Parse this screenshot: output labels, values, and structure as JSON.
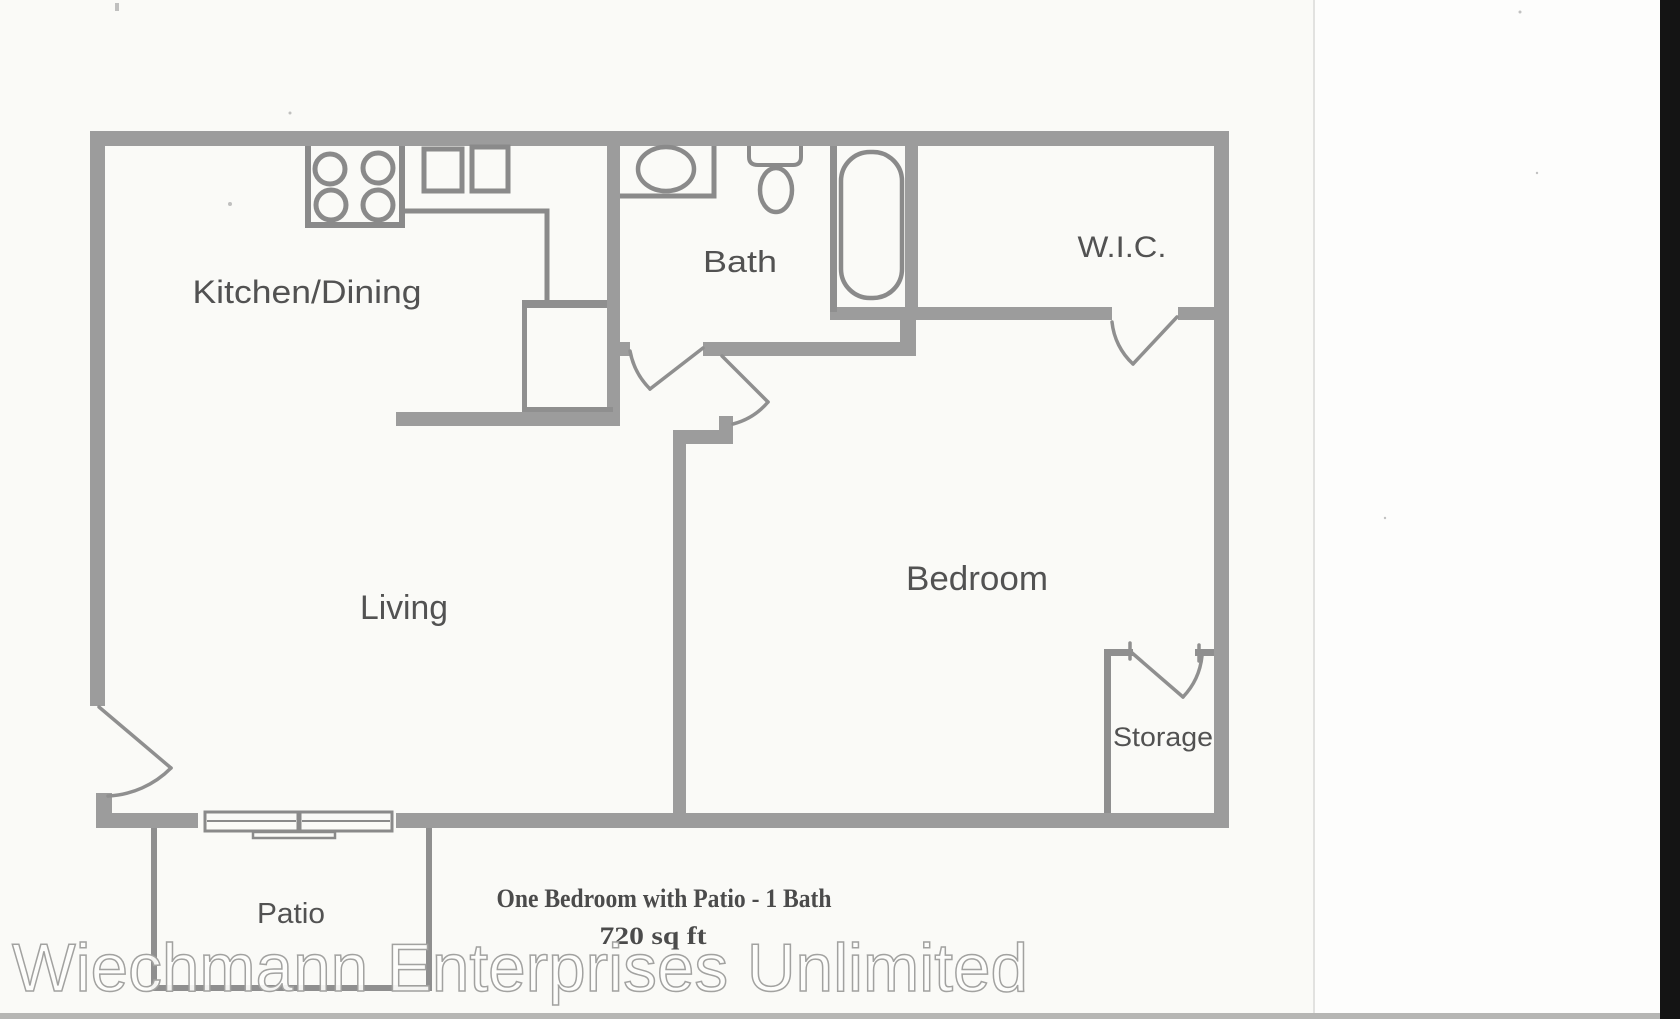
{
  "document": {
    "kind": "scanned-floor-plan",
    "rooms": {
      "kitchen_dining": "Kitchen/Dining",
      "bath": "Bath",
      "wic": "W.I.C.",
      "living": "Living",
      "bedroom": "Bedroom",
      "storage": "Storage",
      "patio": "Patio"
    },
    "title": {
      "line1": "One Bedroom with Patio - 1 Bath",
      "line2": "720 sq ft"
    },
    "watermark": "Wiechmann Enterprises Unlimited",
    "colors": {
      "paper": "#fafaf7",
      "paper_right": "#fdfdfc",
      "wall": "#9c9c9c",
      "thin_line": "#8f8f8f",
      "label_text": "#525252",
      "title_text": "#4b4b4b",
      "watermark_stroke": "#a2a2a0",
      "scan_edge_strip": "#141414",
      "scan_bottom_band": "#b6b6b4",
      "fold_line": "#e2e2e0"
    }
  }
}
